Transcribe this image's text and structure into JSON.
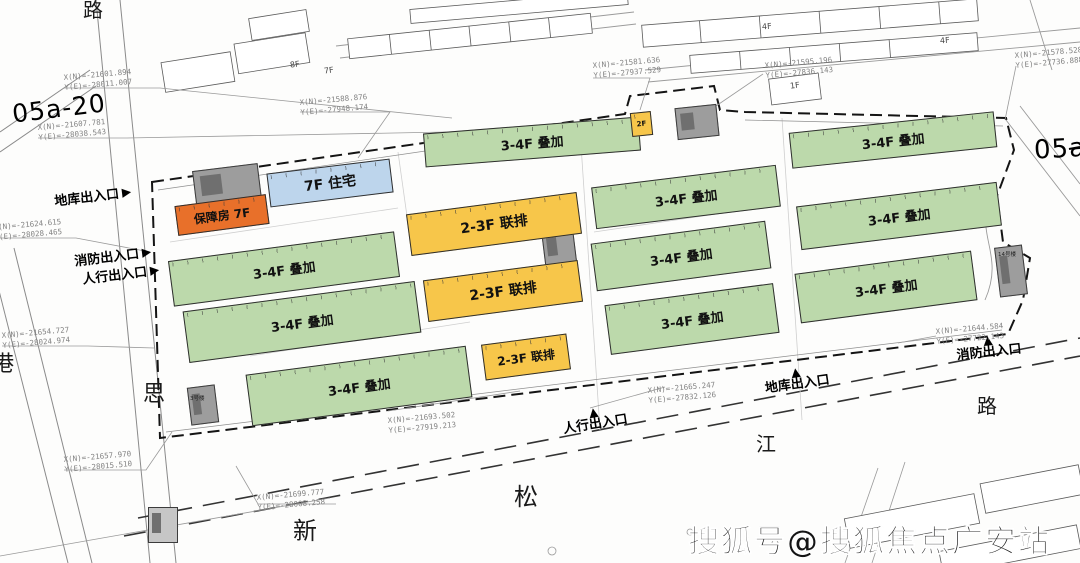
{
  "plot_codes": {
    "top_left": "05a-20",
    "right_edge": "05a-"
  },
  "watermark": {
    "text": "搜狐号@搜狐焦点广安站"
  },
  "icons": {
    "arrow_right": "▶",
    "arrow_up": "▲"
  },
  "colors": {
    "stacked_green": "#bcd9ab",
    "townhouse_yellow": "#f7c64a",
    "residence_blue": "#bdd5ec",
    "affordable_orange": "#e8702a",
    "annotation_gray": "#828282"
  },
  "buildings": [
    {
      "label": "保障房 7F",
      "type": "affordable-housing"
    },
    {
      "label": "7F 住宅",
      "type": "residence"
    },
    {
      "label": "3-4F 叠加",
      "type": "stacked"
    },
    {
      "label": "3-4F 叠加",
      "type": "stacked"
    },
    {
      "label": "3-4F 叠加",
      "type": "stacked"
    },
    {
      "label": "3-4F 叠加",
      "type": "stacked"
    },
    {
      "label": "3-4F 叠加",
      "type": "stacked"
    },
    {
      "label": "3-4F 叠加",
      "type": "stacked"
    },
    {
      "label": "3-4F 叠加",
      "type": "stacked"
    },
    {
      "label": "3-4F 叠加",
      "type": "stacked"
    },
    {
      "label": "3-4F 叠加",
      "type": "stacked"
    },
    {
      "label": "3-4F 叠加",
      "type": "stacked"
    },
    {
      "label": "2-3F 联排",
      "type": "townhouse"
    },
    {
      "label": "2-3F 联排",
      "type": "townhouse"
    },
    {
      "label": "2-3F 联排",
      "type": "townhouse"
    },
    {
      "label": "2F",
      "type": "townhouse-small"
    }
  ],
  "entrances": [
    {
      "label": "地库出入口"
    },
    {
      "label": "消防出入口"
    },
    {
      "label": "人行出入口"
    },
    {
      "label": "人行出入口"
    },
    {
      "label": "地库出入口"
    },
    {
      "label": "消防出入口"
    }
  ],
  "road_names": [
    "路",
    "港",
    "思",
    "新",
    "松",
    "江",
    "路"
  ],
  "surrounding_labels": [
    "7F",
    "8F",
    "4F",
    "4F",
    "1F",
    "3号楼",
    "14号楼"
  ],
  "coordinates": [
    {
      "n": "X(N)=-21601.894",
      "e": "Y(E)=-28011.007"
    },
    {
      "n": "X(N)=-21607.781",
      "e": "Y(E)=-28038.543"
    },
    {
      "n": "X(N)=-21624.615",
      "e": "Y(E)=-28028.465"
    },
    {
      "n": "X(N)=-21654.727",
      "e": "Y(E)=-28024.974"
    },
    {
      "n": "X(N)=-21657.970",
      "e": "Y(E)=-28015.510"
    },
    {
      "n": "X(N)=-21588.876",
      "e": "Y(E)=-27948.174"
    },
    {
      "n": "X(N)=-21581.636",
      "e": "Y(E)=-27937.529"
    },
    {
      "n": "X(N)=-21595.196",
      "e": "Y(E)=-27836.143"
    },
    {
      "n": "X(N)=-21578.528",
      "e": "Y(E)=-27736.888"
    },
    {
      "n": "X(N)=-21693.502",
      "e": "Y(E)=-27919.213"
    },
    {
      "n": "X(N)=-21665.247",
      "e": "Y(E)=-27832.126"
    },
    {
      "n": "X(N)=-21644.584",
      "e": "Y(E)=-27722.143"
    },
    {
      "n": "X(N)=-21699.777",
      "e": "Y(E)=-28008.258"
    }
  ]
}
